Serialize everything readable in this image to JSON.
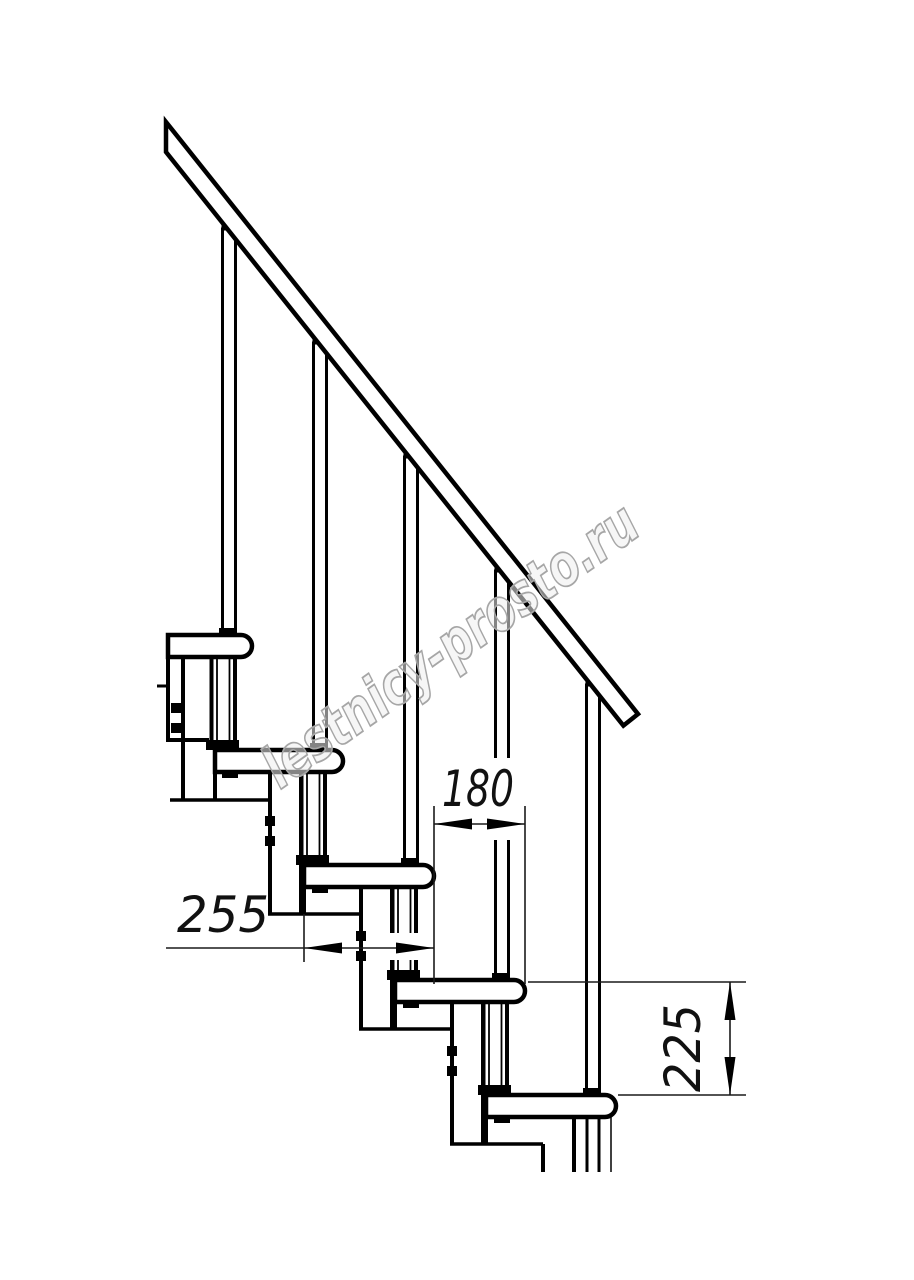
{
  "drawing": {
    "title": "staircase-fragment-technical-drawing",
    "watermark": "lestnicy-prosto.ru",
    "dimensions": {
      "tread_depth": {
        "value": "255",
        "orientation": "horizontal"
      },
      "step_run": {
        "value": "180",
        "orientation": "horizontal"
      },
      "step_rise": {
        "value": "225",
        "orientation": "vertical"
      }
    },
    "colors": {
      "structure_line": "#000000",
      "dimension_line": "#1a1a1a",
      "watermark_stroke": "#a6a6a6",
      "watermark_fill": "rgba(238,238,238,0.55)",
      "background": "#ffffff"
    }
  }
}
